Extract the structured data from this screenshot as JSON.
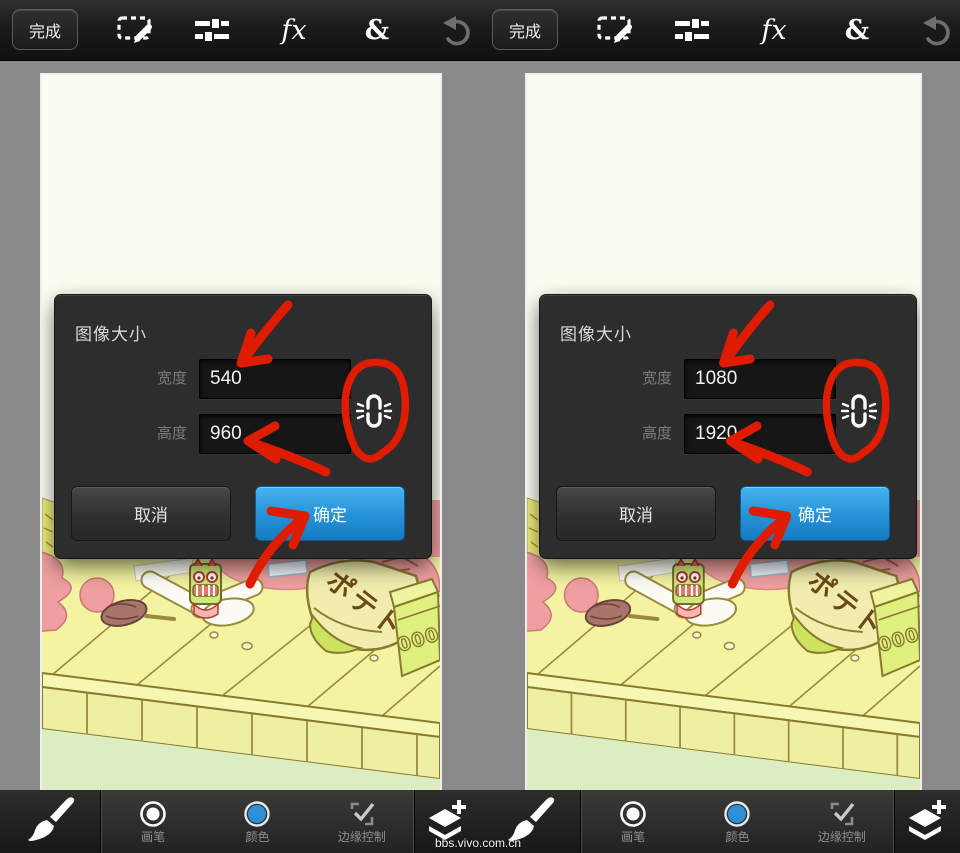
{
  "page": {
    "watermark": "bbs.vivo.com.cn"
  },
  "colors": {
    "accent_blue": "#2492d8",
    "doodle_red": "#df1b00",
    "canvas_ivory": "#fbfdf0",
    "workspace_gray": "#8a8a8a",
    "dialog_bg": "#2d2d2d",
    "color_swatch_blue": "#2e8fd8"
  },
  "panels": [
    {
      "topbar": {
        "done_label": "完成",
        "fx_label": "fx",
        "blend_label": "&"
      },
      "dialog": {
        "title": "图像大小",
        "width_label": "宽度",
        "width_value": "540",
        "height_label": "高度",
        "height_value": "960",
        "cancel_label": "取消",
        "ok_label": "确定"
      },
      "bottombar": {
        "brush_label": "画笔",
        "color_label": "颜色",
        "edge_label": "边缘控制"
      }
    },
    {
      "topbar": {
        "done_label": "完成",
        "fx_label": "fx",
        "blend_label": "&"
      },
      "dialog": {
        "title": "图像大小",
        "width_label": "宽度",
        "width_value": "1080",
        "height_label": "高度",
        "height_value": "1920",
        "cancel_label": "取消",
        "ok_label": "确定"
      },
      "bottombar": {
        "brush_label": "画笔",
        "color_label": "颜色",
        "edge_label": "边缘控制"
      }
    }
  ],
  "illustration": {
    "bag_text": "ポテト",
    "carton_text": "000"
  }
}
